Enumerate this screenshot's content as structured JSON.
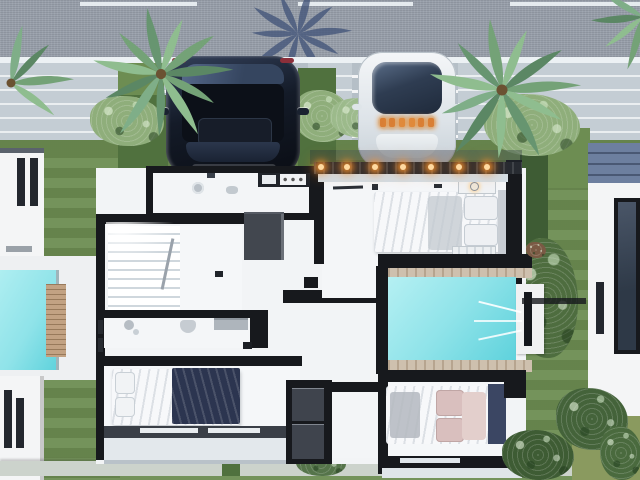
{
  "meta": {
    "title": "Aerial top-down 3D rendering of a modern villa floor plan with street, two parked cars, palm trees, landscaped yards and swimming pools",
    "view": "top-down"
  },
  "palette": {
    "asphalt": "#99a0ab",
    "road_line": "#ecf1f4",
    "sidewalk": "#c4cdd4",
    "paving": "#b5bfc7",
    "grass": "#6d8d52",
    "grass_dark": "#50713e",
    "hedge": "#3e5c34",
    "bush_base": "#8fae7b",
    "pool_water": "#8fe3e9",
    "pool_water_deep": "#5ed2dc",
    "deck_white": "#eef0f2",
    "floor_white": "#f2f4f6",
    "wall_black": "#17191d",
    "closet_gray": "#42474f",
    "wood_deck": "#c2a283",
    "travertine": "#cec0ae",
    "car_dark": "#141b28",
    "car_white": "#e6eaee",
    "glass_dark": "#2f3d52",
    "light_warm": "#ffa94d",
    "bed_navy": "#2c3550",
    "pillow_blush": "#d9bfbe",
    "roof_blue": "#6d7f9f",
    "shadow_blue": "#43557a",
    "building_white": "#f4f5f6",
    "window_dark": "#23272e"
  },
  "scene": {
    "street": {
      "label": "asphalt-road",
      "dash_count": 3
    },
    "vehicles": [
      {
        "label": "dark-suv"
      },
      {
        "label": "white-sports-car"
      }
    ],
    "pergola": {
      "light_count": 7
    },
    "pools": [
      {
        "label": "neighbor-pool-left"
      },
      {
        "label": "villa-pool-right"
      }
    ],
    "palms": {
      "count": 4
    },
    "rooms": [
      "utility-room",
      "master-bedroom",
      "stair-hall",
      "bathroom",
      "bedroom-left",
      "bedroom-right",
      "pool-terrace",
      "balcony"
    ]
  }
}
